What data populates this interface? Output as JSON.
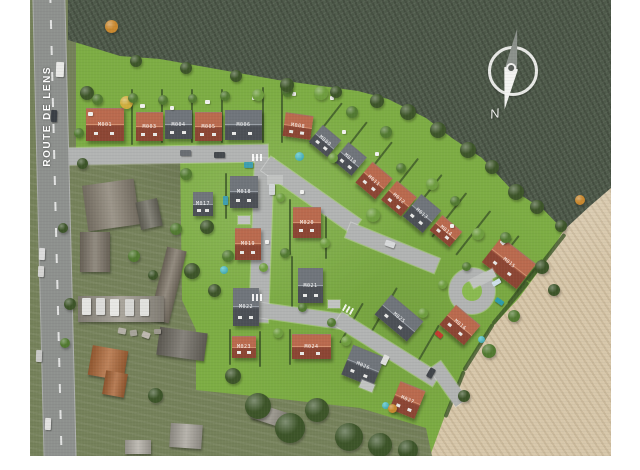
{
  "labels": {
    "road": "ROUTE DE LENS",
    "compass_north": "N"
  },
  "colors": {
    "vars": {
      "lawn": "#7dad44",
      "lawn2": "#8aba50",
      "darkfield": "#4f5b4b",
      "tan": "#d8c8ab",
      "aerial": "#75815a",
      "road": "#b2b4b3",
      "asphalt": "#8e918e",
      "redroof2": "#ba6a4e",
      "redroofdk": "#8c4634",
      "grayroof2": "#70757b",
      "grayroofdk": "#4c5056",
      "hedge": "#3c5628"
    },
    "tree": {
      "dk": "#3d5529",
      "md": "#527a31",
      "lt": "#6f9e3f",
      "or": "#c8882f",
      "ylw": "#d0ae3d"
    }
  },
  "roads": [
    {
      "x": 36,
      "y": 148,
      "w": 202,
      "h": 17,
      "r": -1
    },
    {
      "x": 222,
      "y": 158,
      "w": 19,
      "h": 164,
      "r": 2
    },
    {
      "x": 236,
      "y": 155,
      "w": 110,
      "h": 17,
      "r": 35
    },
    {
      "x": 318,
      "y": 222,
      "w": 96,
      "h": 16,
      "r": 22
    },
    {
      "x": 226,
      "y": 302,
      "w": 92,
      "h": 15,
      "r": 8
    },
    {
      "x": 308,
      "y": 311,
      "w": 116,
      "h": 15,
      "r": 32
    },
    {
      "x": 405,
      "y": 358,
      "w": 46,
      "h": 14,
      "r": 55
    }
  ],
  "houses": [
    {
      "x": 56,
      "y": 108,
      "w": 38,
      "h": 33,
      "r": 0,
      "c": "red",
      "code": "M001"
    },
    {
      "x": 106,
      "y": 112,
      "w": 27,
      "h": 29,
      "r": 0,
      "c": "red",
      "code": "M003"
    },
    {
      "x": 135,
      "y": 110,
      "w": 27,
      "h": 29,
      "r": 0,
      "c": "gray",
      "code": "M004"
    },
    {
      "x": 165,
      "y": 112,
      "w": 27,
      "h": 29,
      "r": 0,
      "c": "red",
      "code": "M005"
    },
    {
      "x": 195,
      "y": 110,
      "w": 37,
      "h": 30,
      "r": 0,
      "c": "gray",
      "code": "M006"
    },
    {
      "x": 254,
      "y": 114,
      "w": 28,
      "h": 24,
      "r": 8,
      "c": "red",
      "code": "M008"
    },
    {
      "x": 283,
      "y": 130,
      "w": 24,
      "h": 22,
      "r": 40,
      "c": "gray",
      "code": "M009"
    },
    {
      "x": 308,
      "y": 147,
      "w": 24,
      "h": 24,
      "r": 40,
      "c": "gray",
      "code": "M010"
    },
    {
      "x": 331,
      "y": 167,
      "w": 26,
      "h": 27,
      "r": 40,
      "c": "red",
      "code": "M011"
    },
    {
      "x": 356,
      "y": 186,
      "w": 26,
      "h": 25,
      "r": 40,
      "c": "red",
      "code": "M012"
    },
    {
      "x": 379,
      "y": 199,
      "w": 26,
      "h": 29,
      "r": 40,
      "c": "gray",
      "code": "M013"
    },
    {
      "x": 403,
      "y": 221,
      "w": 26,
      "h": 20,
      "r": 40,
      "c": "red",
      "code": "M014"
    },
    {
      "x": 457,
      "y": 247,
      "w": 44,
      "h": 32,
      "r": 38,
      "c": "red",
      "code": "M015"
    },
    {
      "x": 414,
      "y": 312,
      "w": 32,
      "h": 26,
      "r": 40,
      "c": "red",
      "code": "M016"
    },
    {
      "x": 163,
      "y": 192,
      "w": 20,
      "h": 24,
      "r": 0,
      "c": "gray",
      "code": "M017"
    },
    {
      "x": 200,
      "y": 176,
      "w": 28,
      "h": 32,
      "r": 0,
      "c": "gray",
      "code": "M018"
    },
    {
      "x": 205,
      "y": 228,
      "w": 26,
      "h": 32,
      "r": 0,
      "c": "red",
      "code": "M019"
    },
    {
      "x": 263,
      "y": 207,
      "w": 28,
      "h": 31,
      "r": 0,
      "c": "red",
      "code": "M020"
    },
    {
      "x": 268,
      "y": 268,
      "w": 25,
      "h": 35,
      "r": 0,
      "c": "gray",
      "code": "M021"
    },
    {
      "x": 203,
      "y": 288,
      "w": 26,
      "h": 38,
      "r": 0,
      "c": "gray",
      "code": "M022"
    },
    {
      "x": 202,
      "y": 336,
      "w": 24,
      "h": 22,
      "r": 0,
      "c": "red",
      "code": "M023"
    },
    {
      "x": 262,
      "y": 334,
      "w": 39,
      "h": 25,
      "r": 0,
      "c": "red",
      "code": "M024"
    },
    {
      "x": 348,
      "y": 305,
      "w": 42,
      "h": 26,
      "r": 40,
      "c": "gray",
      "code": "M025"
    },
    {
      "x": 316,
      "y": 350,
      "w": 34,
      "h": 32,
      "r": 22,
      "c": "gray",
      "code": "M026"
    },
    {
      "x": 364,
      "y": 385,
      "w": 27,
      "h": 30,
      "r": 22,
      "c": "red",
      "code": "M027"
    }
  ],
  "hedges": [
    [
      102,
      88,
      56,
      90
    ],
    [
      132,
      88,
      54,
      90
    ],
    [
      162,
      88,
      54,
      90
    ],
    [
      192,
      88,
      54,
      90
    ],
    [
      233,
      86,
      56,
      90
    ],
    [
      252,
      84,
      58,
      90
    ],
    [
      280,
      143,
      52,
      -52
    ],
    [
      305,
      162,
      52,
      -52
    ],
    [
      330,
      182,
      52,
      -52
    ],
    [
      355,
      200,
      54,
      -52
    ],
    [
      378,
      217,
      55,
      -52
    ],
    [
      402,
      236,
      56,
      -52
    ],
    [
      426,
      254,
      56,
      -52
    ],
    [
      196,
      172,
      46,
      90
    ],
    [
      230,
      170,
      50,
      90
    ],
    [
      260,
      198,
      56,
      90
    ],
    [
      296,
      202,
      56,
      90
    ],
    [
      232,
      256,
      58,
      90
    ],
    [
      262,
      255,
      58,
      90
    ],
    [
      200,
      328,
      36,
      90
    ],
    [
      230,
      330,
      36,
      90
    ],
    [
      260,
      328,
      36,
      90
    ],
    [
      310,
      342,
      46,
      -60
    ],
    [
      342,
      330,
      50,
      -60
    ],
    [
      386,
      364,
      46,
      -60
    ],
    [
      452,
      282,
      60,
      -52
    ],
    [
      478,
      302,
      55,
      -52
    ],
    [
      535,
      232,
      60,
      128,
      4
    ],
    [
      498,
      280,
      55,
      130,
      4
    ],
    [
      463,
      322,
      55,
      122,
      4
    ],
    [
      434,
      369,
      50,
      112,
      4
    ]
  ],
  "trees": [
    [
      50,
      86,
      14,
      "dk"
    ],
    [
      62,
      94,
      11,
      "md"
    ],
    [
      44,
      128,
      10,
      "md"
    ],
    [
      47,
      158,
      11,
      "dk"
    ],
    [
      75,
      20,
      13,
      "or"
    ],
    [
      90,
      96,
      13,
      "ylw"
    ],
    [
      98,
      93,
      10,
      "md"
    ],
    [
      128,
      95,
      10,
      "md"
    ],
    [
      158,
      94,
      9,
      "md"
    ],
    [
      190,
      91,
      10,
      "md"
    ],
    [
      222,
      89,
      12,
      "lt"
    ],
    [
      252,
      86,
      11,
      "md"
    ],
    [
      284,
      86,
      14,
      "lt"
    ],
    [
      316,
      106,
      12,
      "md"
    ],
    [
      350,
      126,
      12,
      "md"
    ],
    [
      298,
      153,
      10,
      "lt"
    ],
    [
      336,
      208,
      14,
      "lt"
    ],
    [
      366,
      163,
      10,
      "md"
    ],
    [
      396,
      178,
      12,
      "lt"
    ],
    [
      420,
      196,
      10,
      "md"
    ],
    [
      442,
      228,
      12,
      "lt"
    ],
    [
      470,
      232,
      11,
      "md"
    ],
    [
      505,
      260,
      14,
      "dk"
    ],
    [
      518,
      284,
      12,
      "dk"
    ],
    [
      545,
      195,
      10,
      "or"
    ],
    [
      478,
      310,
      12,
      "md"
    ],
    [
      452,
      344,
      14,
      "md"
    ],
    [
      428,
      390,
      12,
      "dk"
    ],
    [
      150,
      168,
      12,
      "md"
    ],
    [
      170,
      220,
      14,
      "dk"
    ],
    [
      192,
      250,
      12,
      "md"
    ],
    [
      154,
      263,
      16,
      "dk"
    ],
    [
      178,
      284,
      13,
      "dk"
    ],
    [
      246,
      193,
      9,
      "lt"
    ],
    [
      250,
      248,
      10,
      "md"
    ],
    [
      229,
      263,
      9,
      "lt"
    ],
    [
      290,
      238,
      10,
      "lt"
    ],
    [
      268,
      303,
      9,
      "md"
    ],
    [
      243,
      328,
      10,
      "lt"
    ],
    [
      297,
      318,
      9,
      "md"
    ],
    [
      311,
      336,
      10,
      "lt"
    ],
    [
      358,
      404,
      9,
      "or"
    ],
    [
      215,
      393,
      26,
      "dk"
    ],
    [
      245,
      413,
      30,
      "dk"
    ],
    [
      275,
      398,
      24,
      "dk"
    ],
    [
      305,
      423,
      28,
      "dk"
    ],
    [
      338,
      433,
      24,
      "dk"
    ],
    [
      368,
      440,
      20,
      "dk"
    ],
    [
      195,
      368,
      16,
      "dk"
    ],
    [
      118,
      388,
      15,
      "dk"
    ],
    [
      34,
      298,
      12,
      "dk"
    ],
    [
      30,
      338,
      10,
      "md"
    ],
    [
      28,
      223,
      10,
      "dk"
    ],
    [
      140,
      223,
      12,
      "md"
    ],
    [
      98,
      250,
      12,
      "md"
    ],
    [
      118,
      270,
      10,
      "dk"
    ],
    [
      388,
      308,
      10,
      "lt"
    ],
    [
      408,
      280,
      9,
      "lt"
    ],
    [
      432,
      262,
      9,
      "md"
    ],
    [
      100,
      55,
      12,
      "dk"
    ],
    [
      150,
      62,
      12,
      "dk"
    ],
    [
      200,
      70,
      12,
      "dk"
    ],
    [
      250,
      78,
      14,
      "dk"
    ],
    [
      300,
      86,
      12,
      "dk"
    ],
    [
      340,
      94,
      14,
      "dk"
    ],
    [
      370,
      104,
      16,
      "dk"
    ],
    [
      400,
      122,
      16,
      "dk"
    ],
    [
      430,
      142,
      16,
      "dk"
    ],
    [
      455,
      160,
      14,
      "dk"
    ],
    [
      478,
      184,
      16,
      "dk"
    ],
    [
      500,
      200,
      14,
      "dk"
    ],
    [
      525,
      220,
      12,
      "dk"
    ]
  ],
  "buildings": [
    [
      55,
      182,
      52,
      46,
      -8,
      "#8a8274"
    ],
    [
      108,
      200,
      22,
      28,
      -12,
      "#6e6c60"
    ],
    [
      50,
      232,
      30,
      40,
      0,
      "#7d7568"
    ],
    [
      128,
      248,
      20,
      74,
      14,
      "#7e7567"
    ],
    [
      48,
      296,
      86,
      26,
      0,
      "#9b968b"
    ],
    [
      60,
      348,
      36,
      30,
      10,
      "#b06a3a"
    ],
    [
      74,
      372,
      22,
      24,
      10,
      "#aa6536"
    ],
    [
      128,
      330,
      48,
      28,
      8,
      "#6f6b62"
    ],
    [
      140,
      424,
      32,
      24,
      4,
      "#a9a59c"
    ],
    [
      222,
      408,
      38,
      16,
      18,
      "#8e8a7f"
    ],
    [
      95,
      440,
      26,
      14,
      0,
      "#b3afa6"
    ]
  ],
  "vehicles": [
    [
      26,
      62,
      8,
      15,
      2,
      "#e9e9e7"
    ],
    [
      21,
      110,
      6,
      12,
      2,
      "#3a3f45"
    ],
    [
      9,
      248,
      6,
      12,
      2,
      "#dcdcdc"
    ],
    [
      8,
      266,
      6,
      11,
      2,
      "#d6d6d4"
    ],
    [
      6,
      350,
      6,
      12,
      2,
      "#c9c9c7"
    ],
    [
      15,
      418,
      6,
      12,
      2,
      "#e2e2e0"
    ],
    [
      150,
      150,
      11,
      6,
      0,
      "#6a6e73"
    ],
    [
      184,
      152,
      11,
      6,
      0,
      "#45494e"
    ],
    [
      214,
      162,
      9,
      6,
      0,
      "#3f9fb0"
    ],
    [
      239,
      184,
      6,
      11,
      0,
      "#d3d6d8"
    ],
    [
      355,
      241,
      10,
      6,
      20,
      "#d8dadb"
    ],
    [
      462,
      280,
      9,
      5,
      -30,
      "#cfdfe9"
    ],
    [
      465,
      299,
      9,
      5,
      35,
      "#2f9daa"
    ],
    [
      352,
      355,
      6,
      10,
      25,
      "#e0e0de"
    ],
    [
      398,
      368,
      6,
      10,
      30,
      "#41454a"
    ],
    [
      405,
      332,
      8,
      5,
      40,
      "#c23b30"
    ],
    [
      193,
      196,
      5,
      9,
      0,
      "#3f9fb0"
    ],
    [
      470,
      238,
      10,
      5,
      -40,
      "#e6e6e4"
    ],
    [
      52,
      298,
      9,
      17,
      0,
      "#e5e5e2"
    ],
    [
      66,
      298,
      9,
      17,
      0,
      "#dddddb"
    ],
    [
      80,
      299,
      9,
      17,
      0,
      "#e8e8e5"
    ],
    [
      95,
      299,
      9,
      17,
      0,
      "#d8d8d5"
    ],
    [
      110,
      299,
      9,
      17,
      0,
      "#e2e2df"
    ],
    [
      88,
      328,
      8,
      6,
      10,
      "#b5b1a8"
    ],
    [
      100,
      330,
      7,
      6,
      -8,
      "#a8a49b"
    ],
    [
      112,
      332,
      8,
      6,
      20,
      "#beb9b0"
    ],
    [
      124,
      329,
      7,
      5,
      0,
      "#9d998f"
    ]
  ],
  "objects": [
    [
      "xwalk",
      222,
      154,
      12,
      7,
      0
    ],
    [
      "xwalk",
      222,
      294,
      12,
      7,
      0
    ],
    [
      "xwalk",
      313,
      306,
      10,
      7,
      28
    ],
    [
      "pool",
      265,
      152,
      9,
      9,
      0
    ],
    [
      "pool",
      190,
      266,
      8,
      8,
      0
    ],
    [
      "pool",
      352,
      402,
      7,
      7,
      0
    ],
    [
      "pool",
      448,
      336,
      7,
      7,
      0
    ],
    [
      "dot",
      58,
      112,
      5,
      4,
      0
    ],
    [
      "dot",
      110,
      104,
      5,
      4,
      0
    ],
    [
      "dot",
      140,
      106,
      4,
      4,
      0
    ],
    [
      "dot",
      175,
      100,
      5,
      4,
      0
    ],
    [
      "dot",
      222,
      96,
      4,
      4,
      0
    ],
    [
      "dot",
      262,
      92,
      4,
      4,
      0
    ],
    [
      "dot",
      312,
      130,
      4,
      4,
      0
    ],
    [
      "dot",
      345,
      152,
      4,
      4,
      0
    ],
    [
      "dot",
      420,
      224,
      4,
      4,
      0
    ],
    [
      "dot",
      300,
      96,
      4,
      4,
      0
    ],
    [
      "dot",
      270,
      190,
      4,
      4,
      0
    ],
    [
      "dot",
      235,
      240,
      4,
      4,
      0
    ],
    [
      "drv",
      440,
      274,
      26,
      9,
      -28
    ],
    [
      "drv",
      238,
      176,
      14,
      8,
      0
    ],
    [
      "drv",
      208,
      216,
      12,
      8,
      0
    ],
    [
      "drv",
      298,
      300,
      12,
      8,
      0
    ],
    [
      "drv",
      330,
      382,
      14,
      8,
      22
    ]
  ]
}
